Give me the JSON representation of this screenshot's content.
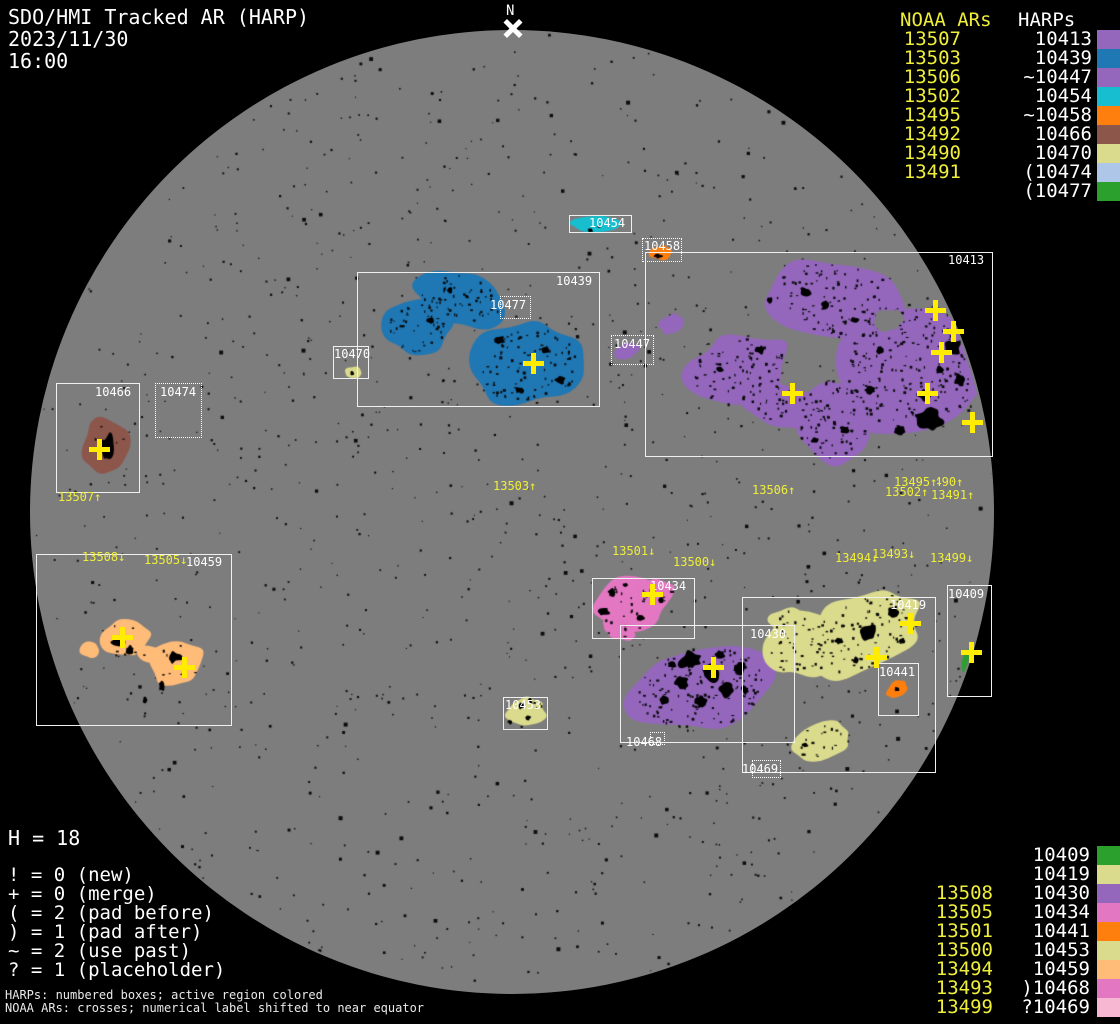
{
  "title": {
    "app": "SDO/HMI Tracked AR (HARP)",
    "date": "2023/11/30",
    "time": "16:00"
  },
  "north_marker": {
    "label": "N"
  },
  "legend_top": {
    "noaa_header": "NOAA ARs",
    "harp_header": "HARPs",
    "rows": [
      {
        "noaa": "13507",
        "harp": "10413",
        "color": "#9467bd"
      },
      {
        "noaa": "13503",
        "harp": "10439",
        "color": "#1f77b4"
      },
      {
        "noaa": "13506",
        "harp": "~10447",
        "color": "#9467bd"
      },
      {
        "noaa": "13502",
        "harp": "10454",
        "color": "#17becf"
      },
      {
        "noaa": "13495",
        "harp": "~10458",
        "color": "#ff7f0e"
      },
      {
        "noaa": "13492",
        "harp": "10466",
        "color": "#8c564b"
      },
      {
        "noaa": "13490",
        "harp": "10470",
        "color": "#dbdb8d"
      },
      {
        "noaa": "13491",
        "harp": "(10474",
        "color": "#aec7e8"
      },
      {
        "noaa": "",
        "harp": "(10477",
        "color": "#2ca02c"
      }
    ]
  },
  "legend_bottom": {
    "rows": [
      {
        "noaa": "",
        "harp": "10409",
        "color": "#2ca02c"
      },
      {
        "noaa": "",
        "harp": "10419",
        "color": "#dbdb8d"
      },
      {
        "noaa": "13508",
        "harp": "10430",
        "color": "#9467bd"
      },
      {
        "noaa": "13505",
        "harp": "10434",
        "color": "#e377c2"
      },
      {
        "noaa": "13501",
        "harp": "10441",
        "color": "#ff7f0e"
      },
      {
        "noaa": "13500",
        "harp": "10453",
        "color": "#dbdb8d"
      },
      {
        "noaa": "13494",
        "harp": "10459",
        "color": "#ffbb78"
      },
      {
        "noaa": "13493",
        "harp": ")10468",
        "color": "#e377c2"
      },
      {
        "noaa": "13499",
        "harp": "?10469",
        "color": "#f7b6d2"
      }
    ]
  },
  "stats": {
    "h_count": "H = 18",
    "flags": [
      "! = 0 (new)",
      "+ = 0 (merge)",
      "( = 2 (pad before)",
      ") = 1 (pad after)",
      "~ = 2 (use past)",
      "? = 1 (placeholder)"
    ]
  },
  "footer": {
    "line1": "HARPs: numbered boxes; active region colored",
    "line2": "NOAA ARs: crosses; numerical label shifted to near equator"
  },
  "harp_boxes": [
    {
      "harp": "10454",
      "x": 569,
      "y": 215,
      "w": 63,
      "h": 18,
      "style": "solid",
      "lx": 589,
      "ly": 217
    },
    {
      "harp": "10458",
      "x": 642,
      "y": 238,
      "w": 40,
      "h": 24,
      "style": "dotted",
      "lx": 644,
      "ly": 240
    },
    {
      "harp": "10413",
      "x": 645,
      "y": 252,
      "w": 348,
      "h": 205,
      "style": "solid",
      "lx": 948,
      "ly": 254
    },
    {
      "harp": "10439",
      "x": 357,
      "y": 272,
      "w": 243,
      "h": 135,
      "style": "solid",
      "lx": 556,
      "ly": 275
    },
    {
      "harp": "10477",
      "x": 500,
      "y": 296,
      "w": 31,
      "h": 23,
      "style": "dotted",
      "lx": 490,
      "ly": 299
    },
    {
      "harp": "10470",
      "x": 333,
      "y": 346,
      "w": 36,
      "h": 33,
      "style": "solid",
      "lx": 334,
      "ly": 348
    },
    {
      "harp": "10447",
      "x": 611,
      "y": 335,
      "w": 43,
      "h": 30,
      "style": "dotted",
      "lx": 614,
      "ly": 338
    },
    {
      "harp": "10466",
      "x": 56,
      "y": 383,
      "w": 84,
      "h": 110,
      "style": "solid",
      "lx": 95,
      "ly": 386
    },
    {
      "harp": "10474",
      "x": 155,
      "y": 383,
      "w": 47,
      "h": 55,
      "style": "dotted",
      "lx": 160,
      "ly": 386
    },
    {
      "harp": "10459",
      "x": 36,
      "y": 554,
      "w": 196,
      "h": 172,
      "style": "solid",
      "lx": 186,
      "ly": 556
    },
    {
      "harp": "10434",
      "x": 592,
      "y": 578,
      "w": 103,
      "h": 61,
      "style": "solid",
      "lx": 650,
      "ly": 580
    },
    {
      "harp": "10430",
      "x": 620,
      "y": 625,
      "w": 175,
      "h": 118,
      "style": "solid",
      "lx": 750,
      "ly": 628
    },
    {
      "harp": "10419",
      "x": 742,
      "y": 597,
      "w": 194,
      "h": 176,
      "style": "solid",
      "lx": 890,
      "ly": 599
    },
    {
      "harp": "10409",
      "x": 947,
      "y": 585,
      "w": 45,
      "h": 112,
      "style": "solid",
      "lx": 948,
      "ly": 588
    },
    {
      "harp": "10441",
      "x": 878,
      "y": 663,
      "w": 41,
      "h": 53,
      "style": "solid",
      "lx": 879,
      "ly": 666
    },
    {
      "harp": "10453",
      "x": 503,
      "y": 697,
      "w": 45,
      "h": 33,
      "style": "solid",
      "lx": 505,
      "ly": 699
    },
    {
      "harp": "10468",
      "x": 650,
      "y": 732,
      "w": 15,
      "h": 13,
      "style": "dotted",
      "lx": 626,
      "ly": 736
    },
    {
      "harp": "10469",
      "x": 752,
      "y": 760,
      "w": 29,
      "h": 18,
      "style": "dotted",
      "lx": 742,
      "ly": 763
    }
  ],
  "noaa_labels": [
    {
      "text": "13507↑",
      "x": 58,
      "y": 491
    },
    {
      "text": "13503↑",
      "x": 493,
      "y": 480
    },
    {
      "text": "13506↑",
      "x": 752,
      "y": 484
    },
    {
      "text": "13490↑",
      "x": 920,
      "y": 476
    },
    {
      "text": "13495↑",
      "x": 894,
      "y": 476,
      "bg": true
    },
    {
      "text": "13502↑",
      "x": 885,
      "y": 486
    },
    {
      "text": "13491↑",
      "x": 931,
      "y": 489
    },
    {
      "text": "13508↓",
      "x": 82,
      "y": 551
    },
    {
      "text": "13505↓",
      "x": 144,
      "y": 554
    },
    {
      "text": "13501↓",
      "x": 612,
      "y": 545
    },
    {
      "text": "13500↓",
      "x": 673,
      "y": 556
    },
    {
      "text": "13494↓",
      "x": 835,
      "y": 552
    },
    {
      "text": "13493↓",
      "x": 872,
      "y": 548
    },
    {
      "text": "13499↓",
      "x": 930,
      "y": 552
    }
  ],
  "crosses": [
    {
      "x": 99,
      "y": 449
    },
    {
      "x": 533,
      "y": 363
    },
    {
      "x": 122,
      "y": 637
    },
    {
      "x": 184,
      "y": 667
    },
    {
      "x": 652,
      "y": 594
    },
    {
      "x": 713,
      "y": 667
    },
    {
      "x": 910,
      "y": 623
    },
    {
      "x": 876,
      "y": 657
    },
    {
      "x": 971,
      "y": 652
    },
    {
      "x": 935,
      "y": 310
    },
    {
      "x": 953,
      "y": 331
    },
    {
      "x": 941,
      "y": 352
    },
    {
      "x": 927,
      "y": 393
    },
    {
      "x": 972,
      "y": 422
    },
    {
      "x": 792,
      "y": 393
    }
  ],
  "chart_data": {
    "type": "table",
    "title": "SDO/HMI Tracked AR (HARP) 2023/11/30 16:00",
    "columns": [
      "NOAA AR",
      "HARP",
      "region_color"
    ],
    "rows": [
      [
        "13507",
        "10413",
        "#9467bd"
      ],
      [
        "13503",
        "10439",
        "#1f77b4"
      ],
      [
        "13506",
        "~10447",
        "#9467bd"
      ],
      [
        "13502",
        "10454",
        "#17becf"
      ],
      [
        "13495",
        "~10458",
        "#ff7f0e"
      ],
      [
        "13492",
        "10466",
        "#8c564b"
      ],
      [
        "13490",
        "10470",
        "#dbdb8d"
      ],
      [
        "13491",
        "(10474",
        "#aec7e8"
      ],
      [
        "",
        "(10477",
        "#2ca02c"
      ],
      [
        "",
        "10409",
        "#2ca02c"
      ],
      [
        "",
        "10419",
        "#dbdb8d"
      ],
      [
        "13508",
        "10430",
        "#9467bd"
      ],
      [
        "13505",
        "10434",
        "#e377c2"
      ],
      [
        "13501",
        "10441",
        "#ff7f0e"
      ],
      [
        "13500",
        "10453",
        "#dbdb8d"
      ],
      [
        "13494",
        "10459",
        "#ffbb78"
      ],
      [
        "13493",
        ")10468",
        "#e377c2"
      ],
      [
        "13499",
        "?10469",
        "#f7b6d2"
      ]
    ],
    "harp_count": 18,
    "noaa_cross_count": 15
  }
}
